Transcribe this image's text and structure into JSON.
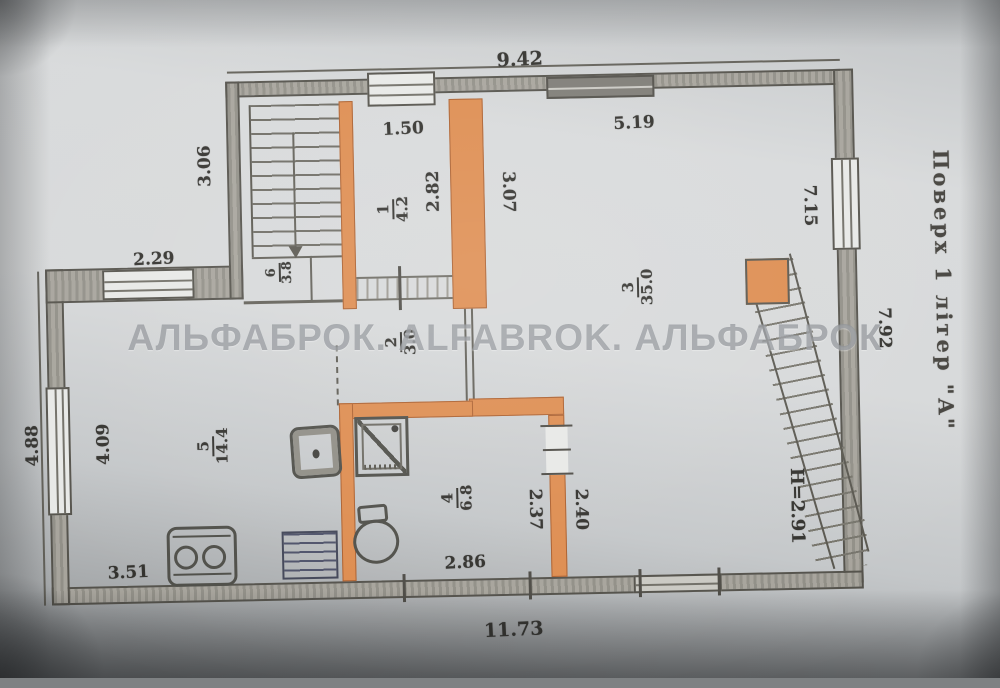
{
  "photo": {
    "watermark": "АЛЬФАБРОК. ALFABROK. АЛЬФАБРОК"
  },
  "plan": {
    "side_title": "Поверх 1 літер \"А\"",
    "ceiling_height": "H=2.91",
    "rooms": [
      {
        "number": "1",
        "area": "4.2"
      },
      {
        "number": "2",
        "area": "3.0"
      },
      {
        "number": "3",
        "area": "35.0"
      },
      {
        "number": "4",
        "area": "6.8"
      },
      {
        "number": "5",
        "area": "14.4"
      },
      {
        "number": "6",
        "area": "3.8"
      }
    ],
    "dimensions": {
      "top_total": "9.42",
      "top_window": "1.50",
      "top_right": "5.19",
      "upper_left": "3.06",
      "step": "2.29",
      "room1_depth": "2.82",
      "room1_right": "3.07",
      "right_upper": "7.15",
      "right_outer": "7.92",
      "left_outer": "4.88",
      "left_inner": "4.09",
      "bottom_left": "3.51",
      "bath_width": "2.86",
      "bath_left": "2.37",
      "bath_right": "2.40",
      "bottom_total": "11.73"
    },
    "colors": {
      "highlight_wall": "#dd8a4c"
    }
  }
}
